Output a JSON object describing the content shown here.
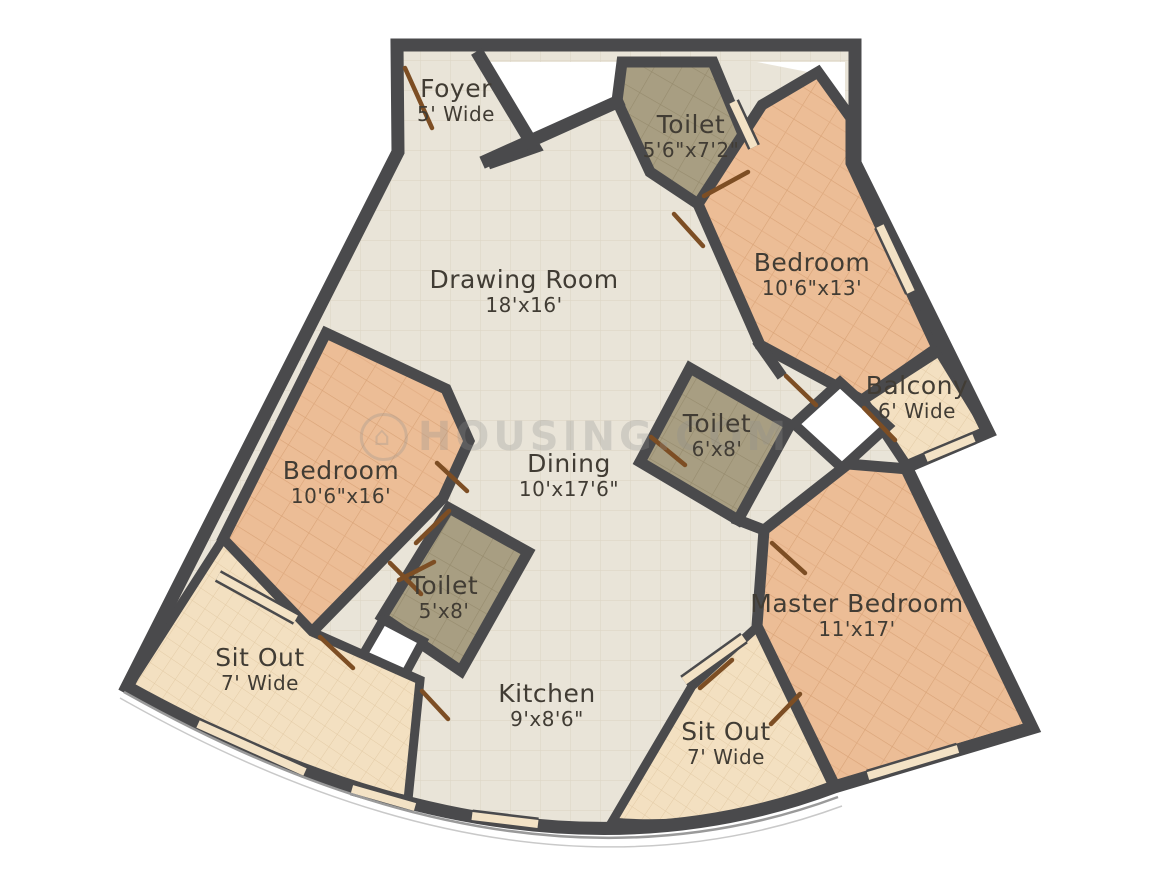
{
  "watermark": {
    "text": "HOUSING.COM"
  },
  "rooms": [
    {
      "id": "foyer",
      "name": "Foyer",
      "dims": "5' Wide"
    },
    {
      "id": "toilet-top",
      "name": "Toilet",
      "dims": "5'6\"x7'2\""
    },
    {
      "id": "bedroom-top",
      "name": "Bedroom",
      "dims": "10'6\"x13'"
    },
    {
      "id": "drawing-room",
      "name": "Drawing Room",
      "dims": "18'x16'"
    },
    {
      "id": "balcony",
      "name": "Balcony",
      "dims": "6' Wide"
    },
    {
      "id": "toilet-mid",
      "name": "Toilet",
      "dims": "6'x8'"
    },
    {
      "id": "bedroom-left",
      "name": "Bedroom",
      "dims": "10'6\"x16'"
    },
    {
      "id": "dining",
      "name": "Dining",
      "dims": "10'x17'6\""
    },
    {
      "id": "toilet-bottom",
      "name": "Toilet",
      "dims": "5'x8'"
    },
    {
      "id": "master-bedroom",
      "name": "Master Bedroom",
      "dims": "11'x17'"
    },
    {
      "id": "sitout-left",
      "name": "Sit Out",
      "dims": "7' Wide"
    },
    {
      "id": "kitchen",
      "name": "Kitchen",
      "dims": "9'x8'6\""
    },
    {
      "id": "sitout-right",
      "name": "Sit Out",
      "dims": "7' Wide"
    }
  ],
  "palette": {
    "wall": "#4a4a4c",
    "floor_common": "#e9e4d8",
    "floor_bedroom": "#ecbd96",
    "floor_toilet": "#a89e82",
    "floor_sitout": "#f3e0c1",
    "door": "#7d4e24",
    "window": "#f3e2c5",
    "label_text": "#413c34"
  }
}
